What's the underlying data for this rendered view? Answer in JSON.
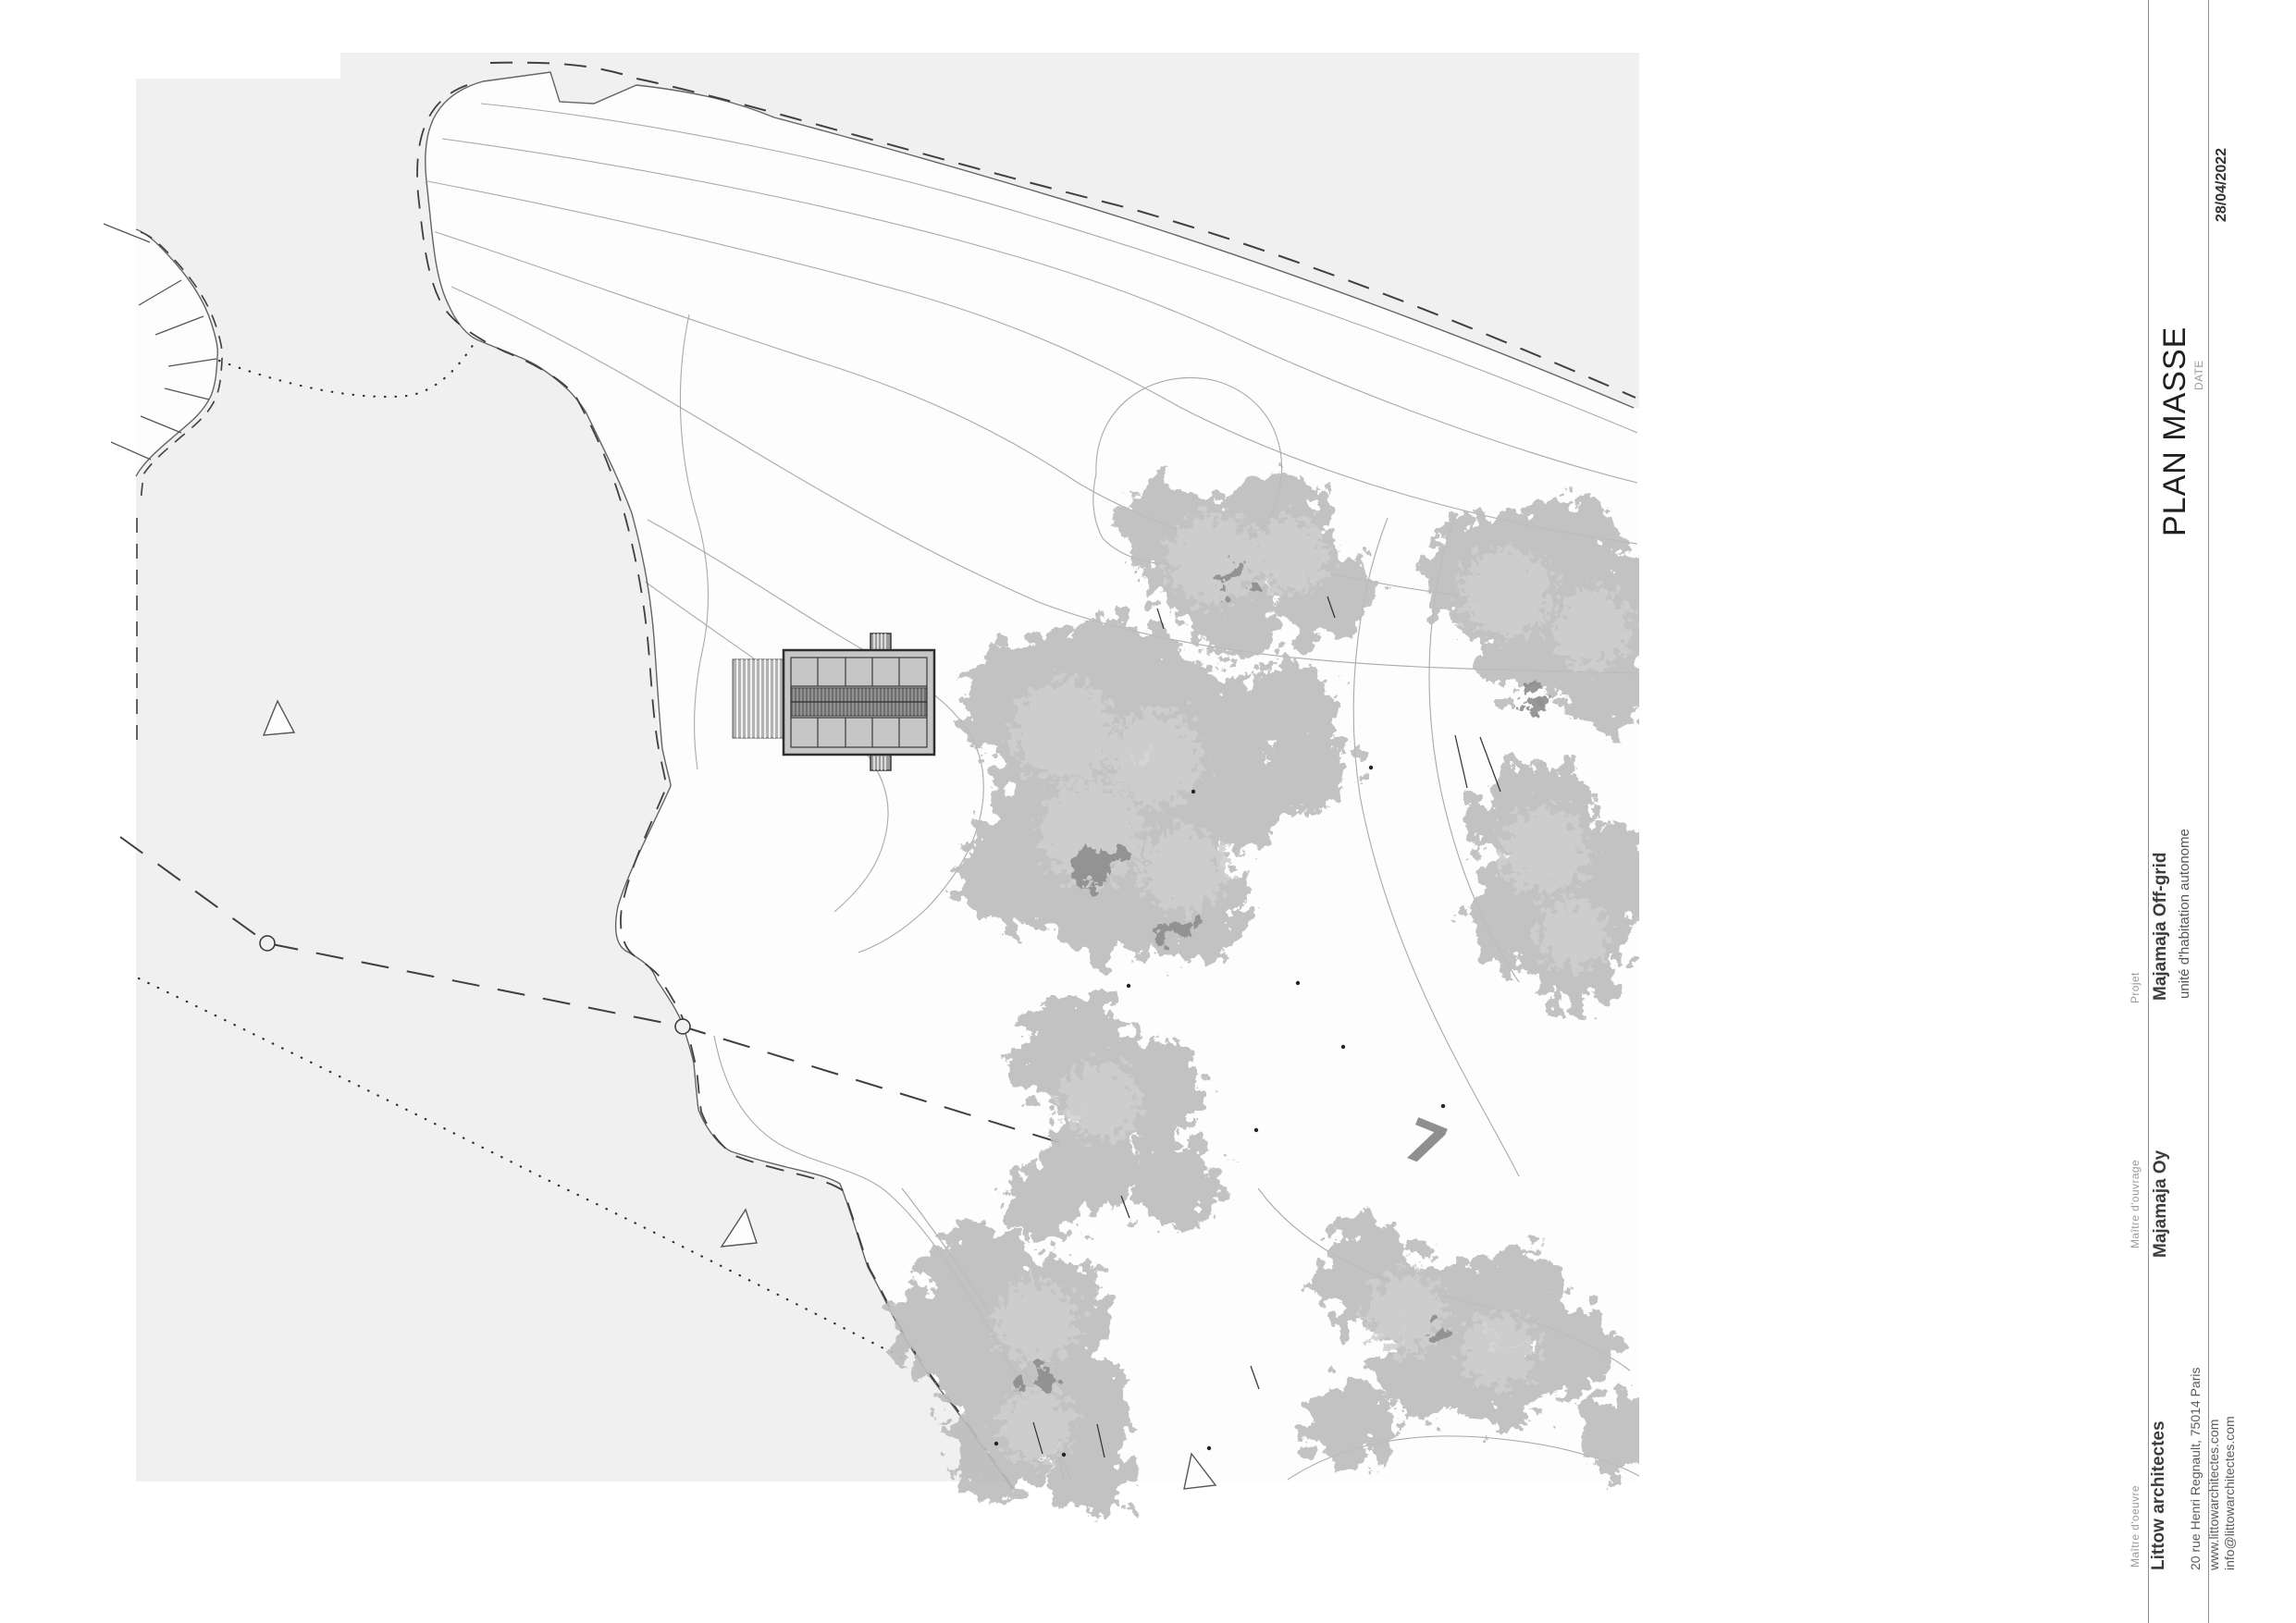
{
  "document": {
    "type_label": "PLAN MASSE",
    "date_label": "DATE",
    "date_value": "28/04/2022"
  },
  "project": {
    "label": "Projet",
    "name": "Majamaja Off-grid",
    "subtitle": "unité d'habitation autonome"
  },
  "client": {
    "label": "Maître d'ouvrage",
    "name": "Majamaja Oy"
  },
  "architect": {
    "label": "Maître d'oeuvre",
    "name": "Littow architectes",
    "address": "20 rue Henri Regnault, 75014 Paris",
    "website": "www.littowarchitectes.com",
    "email": "info@littowarchitectes.com"
  },
  "site": {
    "plot_number": "7"
  },
  "colors": {
    "sea": "#f0f0f0",
    "island": "#fdfdfd",
    "contour": "#a9a9a9",
    "coast": "#646464",
    "boundary": "#3f3f3f",
    "tree": "#bdbdbd",
    "tree_light": "#cfcfcf",
    "tree_dark": "#8d8d8d",
    "building_fill": "#c6c6c6",
    "building_band": "#6f6f6f",
    "plot_number_color": "#8f8f8f"
  }
}
